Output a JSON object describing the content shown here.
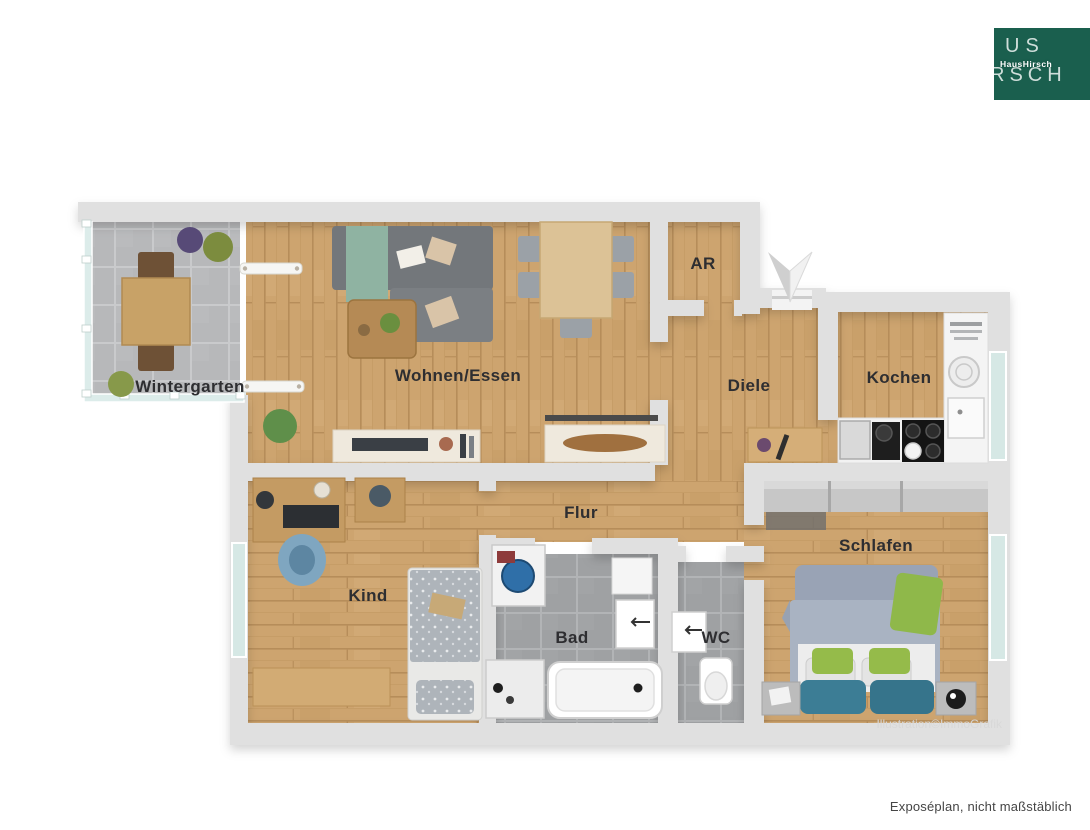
{
  "logo": {
    "line1": "US",
    "line2": "RSCH",
    "overlay": "HausHirsch",
    "bg_color": "#1a5f4e",
    "text_color": "#cfdeda"
  },
  "footer": {
    "note": "Exposéplan, nicht maßstäblich"
  },
  "plan": {
    "watermark": "Illustration©ImmoGrafik",
    "north_arrow": "compass-arrow-pointing-down",
    "rooms": [
      {
        "id": "wintergarten",
        "label": "Wintergarten"
      },
      {
        "id": "wohnen-essen",
        "label": "Wohnen/Essen"
      },
      {
        "id": "ar",
        "label": "AR"
      },
      {
        "id": "diele",
        "label": "Diele"
      },
      {
        "id": "kochen",
        "label": "Kochen"
      },
      {
        "id": "flur",
        "label": "Flur"
      },
      {
        "id": "kind",
        "label": "Kind"
      },
      {
        "id": "bad",
        "label": "Bad"
      },
      {
        "id": "wc",
        "label": "WC"
      },
      {
        "id": "schlafen",
        "label": "Schlafen"
      }
    ],
    "furniture_notes": {
      "wintergarten": "wooden table with two chairs, plants, tiled floor",
      "wohnen_essen": "corner sofa with green throw, coffee table, dining table with five chairs, sideboards",
      "kind": "desk with monitor and chair, single bed, bench",
      "bad": "washing machine, washbasin, bathtub, shower",
      "wc": "washbasin, toilet",
      "schlafen": "double bed with green and teal pillows, wardrobe, two nightstands",
      "kochen": "counters, sink, stove, cooktop"
    }
  },
  "colors": {
    "wood_floor": "#cda46f",
    "bath_tile": "#9fa1a3",
    "wintergarten_tile": "#b7b8ba",
    "wall": "#e0e0e0",
    "window_glass": "#d6e8e5",
    "logo_green": "#1a5f4e",
    "sofa_gray": "#73777b",
    "bed_blue": "#a9b3c2",
    "accent_green": "#93b94d",
    "accent_teal": "#3c7d95"
  }
}
